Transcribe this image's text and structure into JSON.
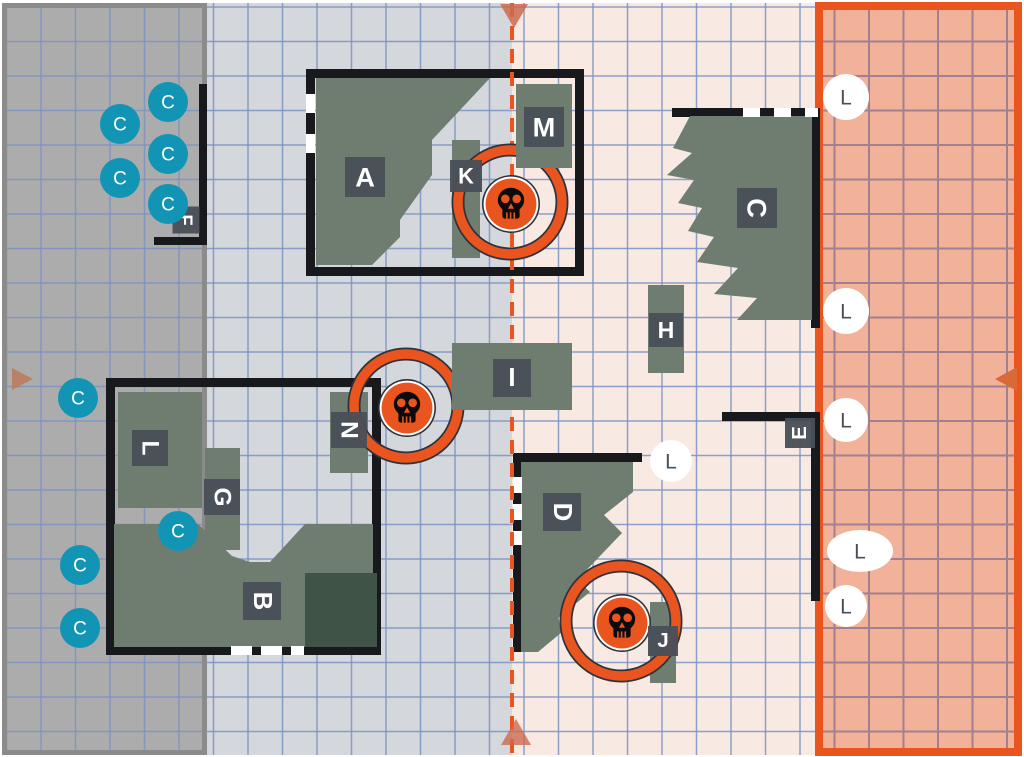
{
  "map": {
    "width": 1024,
    "height": 757,
    "c_letter": "C",
    "l_letter": "L",
    "colors": {
      "page_bg": "#ffffff",
      "neutral_left_bg": "#d4d7db",
      "neutral_right_bg": "#f8e9e3",
      "gray_zone_bg": "#acacac",
      "gray_zone_border": "#8b8b8b",
      "orange_zone_bg": "#f2b199",
      "orange_zone_border": "#ea541e",
      "grid_blue": "#7b93c2",
      "grid_mauve": "#a3808f",
      "terrain_green": "#6e7d70",
      "terrain_dark_green": "#3f5446",
      "label_bg": "#4a4f57",
      "label_text": "#ffffff",
      "wall_black": "#17191d",
      "door_white": "#ffffff",
      "accent_orange": "#ea541e",
      "ring_outline": "#2e333b",
      "skull_black": "#0b0b0d",
      "marker_teal": "#1295b4",
      "marker_white": "#ffffff",
      "marker_letter_gray": "#4a4f57",
      "arrow_center": "#cd6a50",
      "arrow_left": "#b97f63",
      "arrow_right": "#d96a38"
    },
    "grid": {
      "cell": 34.5,
      "offset_x": 6.5,
      "offset_y": 7
    },
    "zones": {
      "neutral_left": {
        "x": 2,
        "y": 3,
        "w": 510,
        "h": 752
      },
      "neutral_right": {
        "x": 512,
        "y": 3,
        "w": 303,
        "h": 752
      },
      "gray": {
        "x": 2,
        "y": 3,
        "w": 205,
        "h": 752,
        "border_w": 5
      },
      "orange": {
        "x": 815,
        "y": 2,
        "w": 207,
        "h": 754,
        "border_w": 8
      }
    },
    "center_line": {
      "x": 512,
      "y1": 3,
      "y2": 753,
      "width": 4,
      "dash": "14 9"
    },
    "rooms": [
      {
        "id": "room-a",
        "x": 306,
        "y": 69,
        "w": 278,
        "h": 207,
        "stroke_w": 9
      },
      {
        "id": "room-b",
        "x": 106,
        "y": 378,
        "w": 275,
        "h": 277,
        "stroke_w": 9
      }
    ],
    "wall_segments": [
      {
        "id": "wall-c-top",
        "x": 672,
        "y": 108,
        "w": 148,
        "h": 9
      },
      {
        "id": "wall-c-right",
        "x": 811,
        "y": 108,
        "w": 9,
        "h": 220
      },
      {
        "id": "wall-d-top",
        "x": 513,
        "y": 453,
        "w": 129,
        "h": 9
      },
      {
        "id": "wall-d-left",
        "x": 513,
        "y": 453,
        "w": 9,
        "h": 199
      },
      {
        "id": "wall-e-top",
        "x": 722,
        "y": 412,
        "w": 98,
        "h": 9
      },
      {
        "id": "wall-e-right",
        "x": 811,
        "y": 412,
        "w": 9,
        "h": 189
      },
      {
        "id": "wall-f-right",
        "x": 199,
        "y": 84,
        "w": 8,
        "h": 161
      },
      {
        "id": "wall-f-bottom",
        "x": 154,
        "y": 237,
        "w": 53,
        "h": 8
      }
    ],
    "doors": [
      {
        "x": 306,
        "y": 94,
        "w": 9,
        "h": 19
      },
      {
        "x": 306,
        "y": 134,
        "w": 9,
        "h": 19
      },
      {
        "x": 231,
        "y": 646,
        "w": 21,
        "h": 9
      },
      {
        "x": 261,
        "y": 646,
        "w": 21,
        "h": 9
      },
      {
        "x": 291,
        "y": 646,
        "w": 13,
        "h": 9
      },
      {
        "x": 743,
        "y": 108,
        "w": 17,
        "h": 9
      },
      {
        "x": 774,
        "y": 108,
        "w": 17,
        "h": 9
      },
      {
        "x": 805,
        "y": 108,
        "w": 13,
        "h": 9
      },
      {
        "x": 513,
        "y": 477,
        "w": 9,
        "h": 16
      },
      {
        "x": 513,
        "y": 504,
        "w": 9,
        "h": 16
      },
      {
        "x": 513,
        "y": 531,
        "w": 9,
        "h": 14
      }
    ],
    "terrain_rects": [
      {
        "id": "K",
        "x": 452,
        "y": 140,
        "w": 28,
        "h": 118,
        "fill": "green"
      },
      {
        "id": "H",
        "x": 648,
        "y": 285,
        "w": 36,
        "h": 88,
        "fill": "green"
      },
      {
        "id": "N",
        "x": 330,
        "y": 392,
        "w": 38,
        "h": 81,
        "fill": "green"
      },
      {
        "id": "L",
        "x": 118,
        "y": 392,
        "w": 84,
        "h": 116,
        "fill": "green"
      },
      {
        "id": "G",
        "x": 205,
        "y": 448,
        "w": 35,
        "h": 102,
        "fill": "green"
      },
      {
        "id": "J",
        "x": 650,
        "y": 602,
        "w": 26,
        "h": 81,
        "fill": "green"
      },
      {
        "id": "B-annex",
        "x": 305,
        "y": 573,
        "w": 72,
        "h": 74,
        "fill": "dark"
      }
    ],
    "terrain_late_rects": [
      {
        "id": "M",
        "x": 516,
        "y": 84,
        "w": 56,
        "h": 84
      },
      {
        "id": "I",
        "x": 452,
        "y": 343,
        "w": 120,
        "h": 67
      }
    ],
    "terrain_polys": [
      {
        "id": "A",
        "points": "316,78 490,78 432,140 432,175 400,220 400,237 372,265 316,265"
      },
      {
        "id": "C",
        "points": "690,116 812,116 812,320 737,320 757,298 714,294 738,268 697,262 714,237 688,231 702,208 678,203 694,180 667,175 692,153 673,148"
      },
      {
        "id": "D",
        "points": "521,462 633,462 633,492 604,515 622,533 577,580 590,592 558,618 562,632 538,652 521,652"
      },
      {
        "id": "B",
        "points": "114,524 198,524 232,556 250,562 270,562 305,524 373,524 373,647 114,647"
      }
    ],
    "labels": [
      {
        "text": "A",
        "x": 365,
        "y": 177,
        "rot": 0,
        "size": 40
      },
      {
        "text": "K",
        "x": 466,
        "y": 176,
        "rot": 0,
        "size": 32
      },
      {
        "text": "M",
        "x": 544,
        "y": 127,
        "rot": 0,
        "size": 40
      },
      {
        "text": "C",
        "x": 757,
        "y": 208,
        "rot": 90,
        "size": 40
      },
      {
        "text": "H",
        "x": 666,
        "y": 330,
        "rot": 0,
        "size": 34
      },
      {
        "text": "I",
        "x": 512,
        "y": 378,
        "rot": 0,
        "size": 38
      },
      {
        "text": "N",
        "x": 349,
        "y": 430,
        "rot": 90,
        "size": 36
      },
      {
        "text": "L",
        "x": 150,
        "y": 448,
        "rot": 90,
        "size": 36
      },
      {
        "text": "G",
        "x": 222,
        "y": 497,
        "rot": 90,
        "size": 36
      },
      {
        "text": "B",
        "x": 262,
        "y": 601,
        "rot": 90,
        "size": 38
      },
      {
        "text": "D",
        "x": 562,
        "y": 512,
        "rot": 90,
        "size": 38
      },
      {
        "text": "J",
        "x": 663,
        "y": 641,
        "rot": 0,
        "size": 30
      },
      {
        "text": "E",
        "x": 800,
        "y": 433,
        "rot": -90,
        "size": 30
      },
      {
        "text": "F",
        "x": 186,
        "y": 220,
        "rot": 90,
        "size": 27
      }
    ],
    "objectives": [
      {
        "ring_x": 510,
        "ring_y": 202,
        "ring_r": 52,
        "skull_x": 511,
        "skull_y": 204
      },
      {
        "ring_x": 406,
        "ring_y": 406,
        "ring_r": 52,
        "skull_x": 407,
        "skull_y": 408
      },
      {
        "ring_x": 621,
        "ring_y": 621,
        "ring_r": 55,
        "skull_x": 622,
        "skull_y": 623
      }
    ],
    "c_markers": [
      {
        "x": 168,
        "y": 102
      },
      {
        "x": 120,
        "y": 124
      },
      {
        "x": 168,
        "y": 154
      },
      {
        "x": 120,
        "y": 178
      },
      {
        "x": 168,
        "y": 204
      },
      {
        "x": 78,
        "y": 398
      },
      {
        "x": 178,
        "y": 531
      },
      {
        "x": 80,
        "y": 565
      },
      {
        "x": 80,
        "y": 628
      }
    ],
    "c_marker_r": 20,
    "l_markers": [
      {
        "x": 846,
        "y": 97,
        "rx": 23,
        "ry": 23
      },
      {
        "x": 846,
        "y": 311,
        "rx": 23,
        "ry": 23
      },
      {
        "x": 846,
        "y": 420,
        "rx": 22,
        "ry": 22
      },
      {
        "x": 860,
        "y": 551,
        "rx": 33,
        "ry": 21
      },
      {
        "x": 846,
        "y": 606,
        "rx": 21,
        "ry": 21
      },
      {
        "x": 671,
        "y": 461,
        "rx": 21,
        "ry": 21
      }
    ],
    "arrows": [
      {
        "name": "center-top-arrow",
        "points": "500,4 528,4 514,28",
        "color_key": "arrow_center",
        "opacity": 0.85
      },
      {
        "name": "center-bottom-arrow",
        "points": "501,745 531,745 516,719",
        "color_key": "arrow_center",
        "opacity": 0.8
      },
      {
        "name": "left-edge-arrow",
        "points": "12,368 12,390 33,379",
        "color_key": "arrow_left",
        "opacity": 0.95
      },
      {
        "name": "right-edge-arrow",
        "points": "1017,367 1017,391 995,379",
        "color_key": "arrow_right",
        "opacity": 1
      }
    ]
  }
}
